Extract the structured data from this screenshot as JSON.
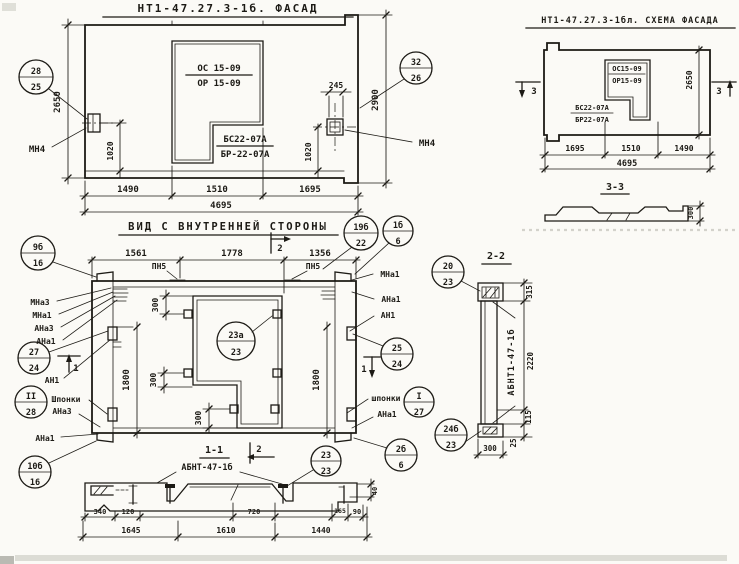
{
  "facade": {
    "title": "НТ1-47.27.3-1б. ФАСАД",
    "window_mark_top": "ОС 15-09",
    "window_mark_bottom": "ОР 15-09",
    "sill_mark_top": "БС22-07А",
    "sill_mark_bottom": "БР-22-07А",
    "plate_left": "МН4",
    "plate_right": "МН4",
    "dim_height": "2650",
    "dim_height_full": "2900",
    "dim_245": "245",
    "dim_1020_left": "1020",
    "dim_1020_right": "1020",
    "dim_w1": "1490",
    "dim_w2": "1510",
    "dim_w3": "1695",
    "dim_total": "4695"
  },
  "scheme": {
    "title": "НТ1-47.27.3-1бл. СХЕМА ФАСАДА",
    "window_mark_top": "ОС15-09",
    "window_mark_bottom": "ОР15-09",
    "sill_mark_top": "БС22-07А",
    "sill_mark_bottom": "БР22-07А",
    "dim_height": "2650",
    "dim_w1": "1695",
    "dim_w2": "1510",
    "dim_w3": "1490",
    "dim_total": "4695",
    "cut_mark": "3",
    "section_title": "3-3",
    "section_dim": "300"
  },
  "inner": {
    "title": "ВИД С ВНУТРЕННЕЙ СТОРОНЫ",
    "dim_w1": "1561",
    "dim_w2": "1778",
    "dim_w3": "1356",
    "pn5": "ПН5",
    "cut_mark_2": "2",
    "cut_mark_1": "1",
    "dim_300": "300",
    "dim_1800": "1800",
    "labels": {
      "mna3": "МНа3",
      "mna1": "МНа1",
      "ana3": "АНа3",
      "ana1": "АНа1",
      "an1": "АН1",
      "shponki_caps": "Шпонки",
      "shponki": "шпонки"
    }
  },
  "section22": {
    "title": "2-2",
    "label": "АБНТ1-47-1б",
    "d315": "315",
    "d2220": "2220",
    "d115": "115",
    "d25": "25",
    "d300": "300"
  },
  "section11": {
    "title": "1-1",
    "label": "АБНТ-47-1б",
    "cut_mark": "2",
    "d340": "340",
    "d120": "120",
    "d720": "720",
    "d165": "165",
    "d90": "90",
    "d40": "40",
    "b1": "1645",
    "b2": "1610",
    "b3": "1440"
  },
  "callouts": [
    {
      "t": "28",
      "b": "25"
    },
    {
      "t": "32",
      "b": "26"
    },
    {
      "t": "9б",
      "b": "16"
    },
    {
      "t": "19б",
      "b": "22"
    },
    {
      "t": "1б",
      "b": "6"
    },
    {
      "t": "27",
      "b": "24"
    },
    {
      "t": "II",
      "b": "28"
    },
    {
      "t": "10б",
      "b": "16"
    },
    {
      "t": "25",
      "b": "24"
    },
    {
      "t": "I",
      "b": "27"
    },
    {
      "t": "2б",
      "b": "6"
    },
    {
      "t": "20",
      "b": "23"
    },
    {
      "t": "24б",
      "b": "23"
    },
    {
      "t": "23а",
      "b": "23"
    },
    {
      "t": "23",
      "b": "23"
    }
  ]
}
